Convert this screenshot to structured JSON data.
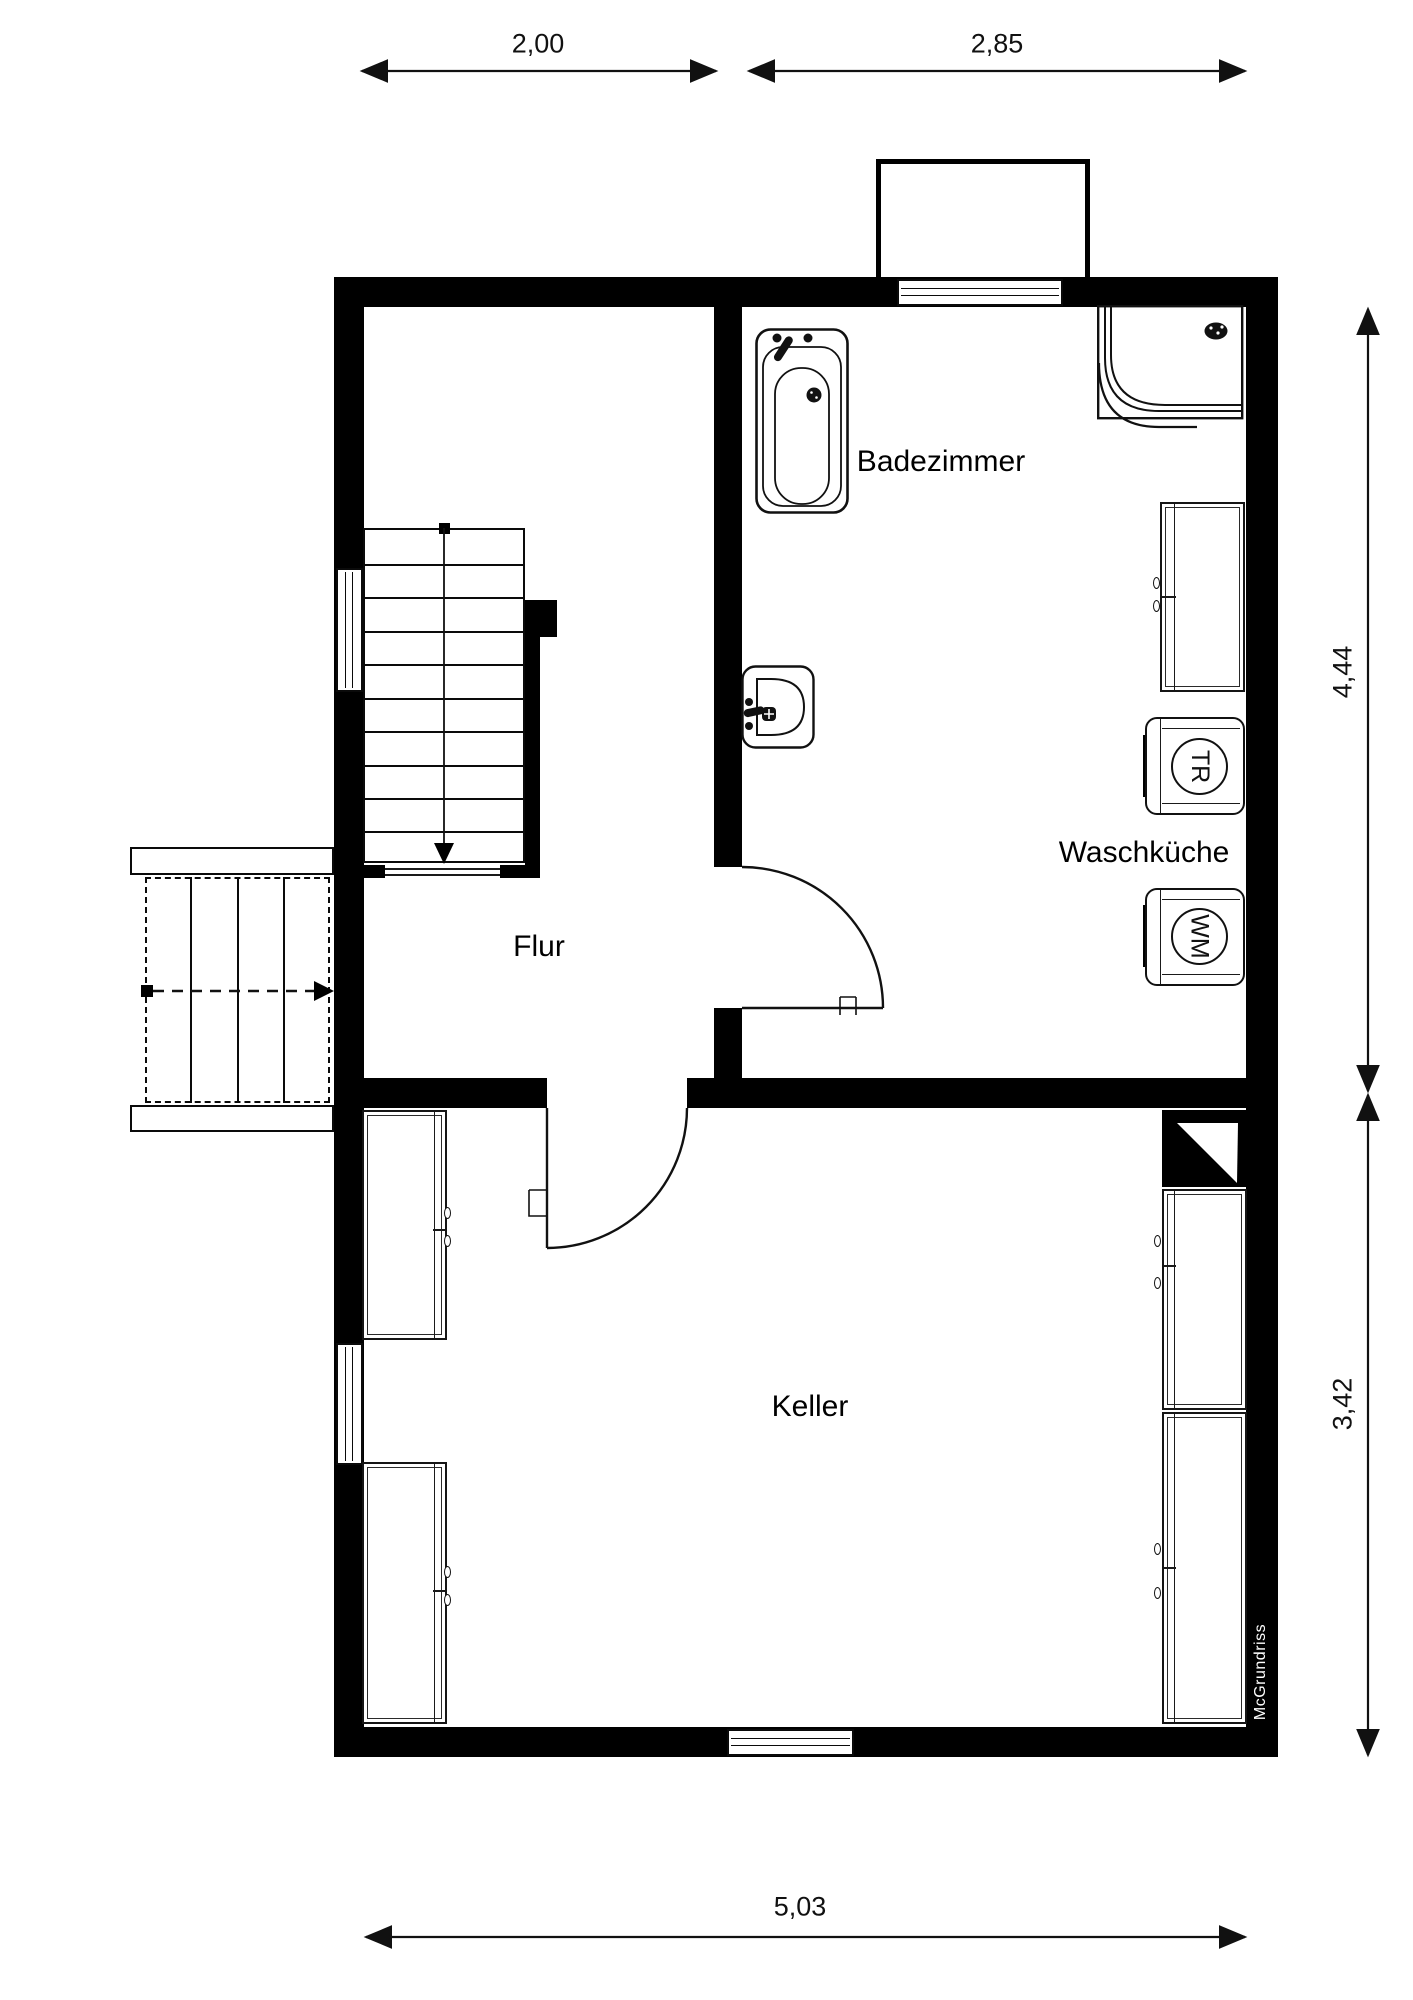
{
  "plan": {
    "rooms": {
      "badezimmer": "Badezimmer",
      "waschkueche": "Waschküche",
      "flur": "Flur",
      "keller": "Keller"
    },
    "appliances": {
      "dryer": "TR",
      "washer": "WM"
    },
    "dimensions": {
      "top_left": "2,00",
      "top_right": "2,85",
      "right_upper": "4,44",
      "right_lower": "3,42",
      "bottom": "5,03"
    },
    "watermark": "McGrundriss",
    "colors": {
      "wall": "#000000",
      "line": "#1a1a1a",
      "background": "#ffffff"
    }
  }
}
